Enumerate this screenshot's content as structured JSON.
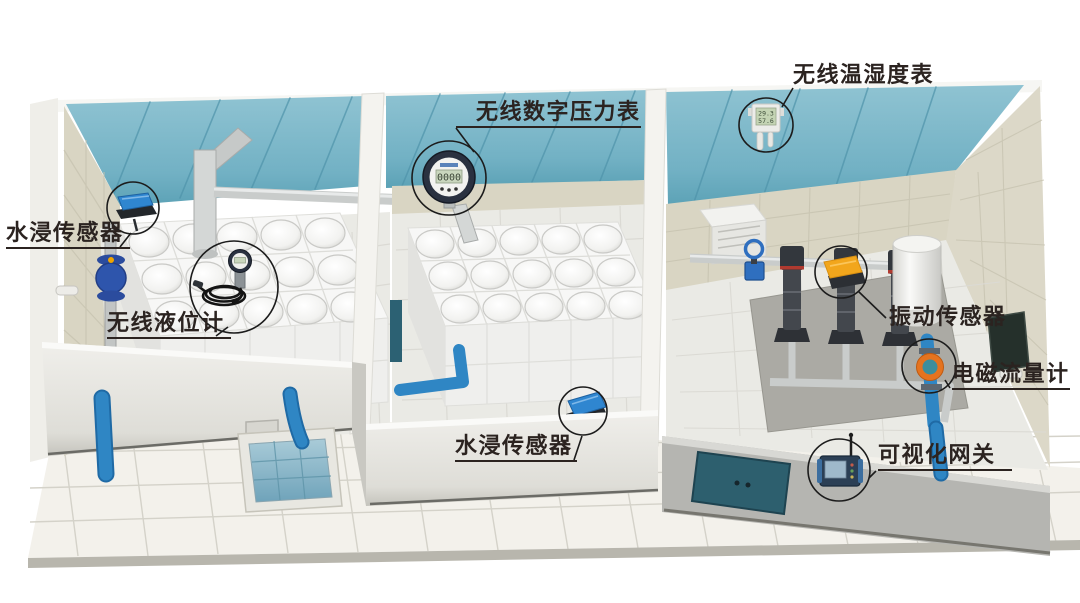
{
  "callouts": [
    {
      "id": "water-leak-sensor-left",
      "label": "水浸传感器"
    },
    {
      "id": "wireless-level-gauge",
      "label": "无线液位计"
    },
    {
      "id": "wireless-digital-pressure-gauge",
      "label": "无线数字压力表"
    },
    {
      "id": "wireless-temp-humidity-meter",
      "label": "无线温湿度表"
    },
    {
      "id": "vibration-sensor",
      "label": "振动传感器"
    },
    {
      "id": "electromagnetic-flowmeter",
      "label": "电磁流量计"
    },
    {
      "id": "water-leak-sensor-floor",
      "label": "水浸传感器"
    },
    {
      "id": "visual-gateway",
      "label": "可视化网关"
    }
  ],
  "readings": {
    "pressure_lcd": "0000",
    "temp_lcd": "29.3",
    "humidity_lcd": "57.6"
  },
  "colors": {
    "ceiling_teal": "#72B1C4",
    "ceiling_seam": "#4E93A9",
    "wall_beige": "#D9D5C3",
    "floor_light": "#EAEAE5",
    "platform_white": "#F3F1EB",
    "front_wall_white": "#EDECE8",
    "front_wall_gray": "#B5B5B1",
    "door_teal": "#2D5F6E",
    "pipe_blue": "#2F86C4",
    "pipe_silver": "#CFD2D1",
    "valve_blue": "#2C4C9C",
    "sensor_blue": "#2F86D0",
    "vibration_yellow": "#F2A61C",
    "flowmeter_orange": "#E5731F",
    "pump_dark": "#43474D",
    "water_blue": "#8FB9CC",
    "label_color": "#2B2320"
  },
  "equipment": [
    "water-tank",
    "water-pump",
    "pressure-tank",
    "control-cabinet",
    "gate-valve",
    "sump-pit",
    "wall-display-panel"
  ]
}
